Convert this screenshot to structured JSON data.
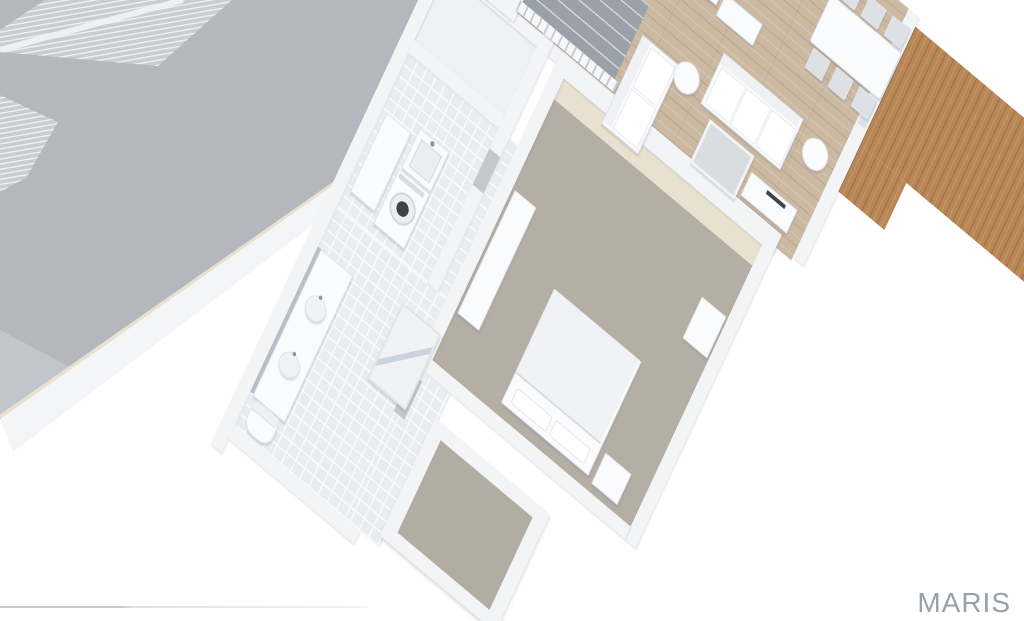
{
  "watermark": {
    "text": "MARIS"
  },
  "palette": {
    "background": "#ffffff",
    "wall": "#f3f4f6",
    "wall_cream": "#e8e1cf",
    "garage_floor": "#b4b7be",
    "garage_floor_light": "#c2c5cb",
    "garage_door_panel": "#c9ccd3",
    "tile_floor": "#e9edf2",
    "wood_floor": "#cbb9a2",
    "deck_wood": "#b98756",
    "carpet": "#b5aea4",
    "carpet_closet": "#b3aca2",
    "stair_void": "#9ba1a9",
    "furniture_white": "#fafbfd",
    "appliance_dark": "#3f4247",
    "watermark_gray": "#9aa0a7",
    "border_line": "#c6cbd2"
  },
  "scene": {
    "type": "3d-floor-plan-render",
    "view": "isometric-birdseye",
    "rooms": [
      {
        "name": "garage",
        "flooring": "concrete-gray",
        "features": [
          "garage-door-panels"
        ]
      },
      {
        "name": "living-room",
        "flooring": "hardwood",
        "furniture": [
          "loveseat",
          "sofa",
          "coffee-table",
          "round-side-table",
          "round-side-table",
          "tv-console"
        ]
      },
      {
        "name": "dining-area",
        "flooring": "hardwood",
        "furniture": [
          "dining-table",
          "dining-chairs"
        ]
      },
      {
        "name": "kitchen",
        "flooring": "hardwood",
        "furniture": [
          "counter",
          "island"
        ]
      },
      {
        "name": "staircase",
        "features": [
          "white-railing",
          "stair-opening"
        ]
      },
      {
        "name": "laundry-room",
        "flooring": "tile",
        "furniture": [
          "counter",
          "utility-sink",
          "washer"
        ]
      },
      {
        "name": "bathroom",
        "flooring": "tile",
        "furniture": [
          "double-vanity",
          "sink",
          "sink",
          "shower",
          "toilet"
        ]
      },
      {
        "name": "bedroom",
        "flooring": "carpet",
        "furniture": [
          "bed",
          "pillows",
          "nightstand",
          "dresser",
          "wall-cabinet"
        ]
      },
      {
        "name": "walk-in-closet",
        "flooring": "carpet",
        "features": [
          "white-shelving-perimeter"
        ]
      },
      {
        "name": "deck",
        "flooring": "wood-planks",
        "location": "exterior-right"
      }
    ]
  }
}
